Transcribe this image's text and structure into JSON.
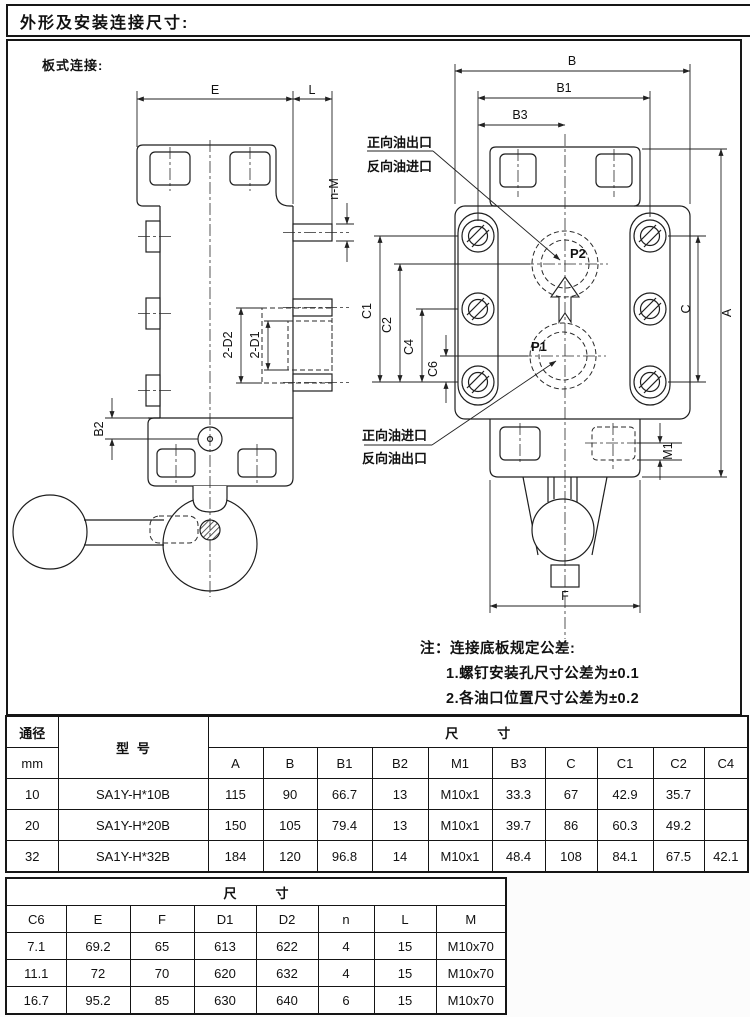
{
  "page": {
    "title": "外形及安装连接尺寸:",
    "subtitle": "板式连接:"
  },
  "drawing": {
    "labels": {
      "e": "E",
      "l": "L",
      "n_m": "n-M",
      "two_d2": "2-D2",
      "two_d1": "2-D1",
      "b2": "B2",
      "b": "B",
      "b1": "B1",
      "b3": "B3",
      "c1": "C1",
      "c2": "C2",
      "c4": "C4",
      "c6": "C6",
      "c": "C",
      "a": "A",
      "m1": "M1",
      "f": "F",
      "p1": "P1",
      "p2": "P2"
    },
    "ports": {
      "top_line1": "正向油出口",
      "top_line2": "反向油进口",
      "bottom_line1": "正向油进口",
      "bottom_line2": "反向油出口"
    },
    "note": {
      "title": "注：连接底板规定公差:",
      "item1": "1.螺钉安装孔尺寸公差为±0.1",
      "item2": "2.各油口位置尺寸公差为±0.2"
    }
  },
  "table1": {
    "header": {
      "diameter": "通径",
      "unit": "mm",
      "model": "型号",
      "size": "尺寸",
      "columns": [
        "A",
        "B",
        "B1",
        "B2",
        "M1",
        "B3",
        "C",
        "C1",
        "C2",
        "C4"
      ]
    },
    "rows": [
      {
        "dn": "10",
        "model": "SA1Y-H*10B",
        "values": [
          "115",
          "90",
          "66.7",
          "13",
          "M10x1",
          "33.3",
          "67",
          "42.9",
          "35.7",
          ""
        ]
      },
      {
        "dn": "20",
        "model": "SA1Y-H*20B",
        "values": [
          "150",
          "105",
          "79.4",
          "13",
          "M10x1",
          "39.7",
          "86",
          "60.3",
          "49.2",
          ""
        ]
      },
      {
        "dn": "32",
        "model": "SA1Y-H*32B",
        "values": [
          "184",
          "120",
          "96.8",
          "14",
          "M10x1",
          "48.4",
          "108",
          "84.1",
          "67.5",
          "42.1"
        ]
      }
    ]
  },
  "table2": {
    "size": "尺寸",
    "columns": [
      "C6",
      "E",
      "F",
      "D1",
      "D2",
      "n",
      "L",
      "M"
    ],
    "rows": [
      [
        "7.1",
        "69.2",
        "65",
        "613",
        "622",
        "4",
        "15",
        "M10x70"
      ],
      [
        "11.1",
        "72",
        "70",
        "620",
        "632",
        "4",
        "15",
        "M10x70"
      ],
      [
        "16.7",
        "95.2",
        "85",
        "630",
        "640",
        "6",
        "15",
        "M10x70"
      ]
    ]
  }
}
